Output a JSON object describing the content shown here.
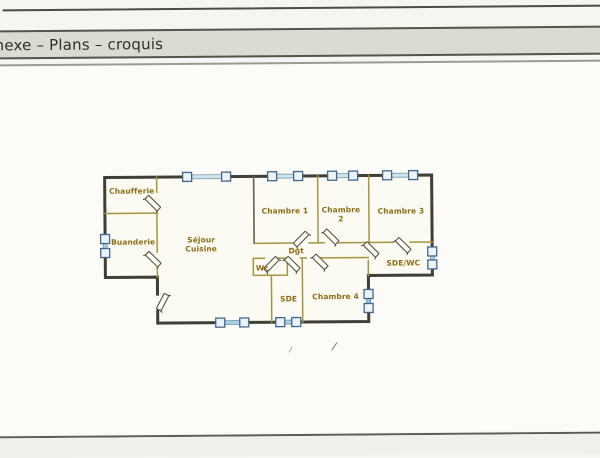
{
  "header": {
    "title": "nexe – Plans – croquis"
  },
  "plan": {
    "type": "floor-plan-sketch",
    "rooms": [
      {
        "name": "Chaufferie"
      },
      {
        "name": "Buanderie"
      },
      {
        "name": "Séjour\nCuisine"
      },
      {
        "name": "Chambre 1"
      },
      {
        "name": "Chambre\n2"
      },
      {
        "name": "Chambre 3"
      },
      {
        "name": "Dgt"
      },
      {
        "name": "Wc"
      },
      {
        "name": "SDE"
      },
      {
        "name": "Chambre 4"
      },
      {
        "name": "SDE/WC"
      }
    ],
    "colors": {
      "exterior_wall": "#403f37",
      "partition_wall": "#a6943e",
      "room_label": "#8c6e16",
      "window_fill": "#aed0e2",
      "window_frame": "#41688a",
      "header_bar": "#d9ddd1"
    },
    "window_count": 9,
    "door_count": 10
  }
}
